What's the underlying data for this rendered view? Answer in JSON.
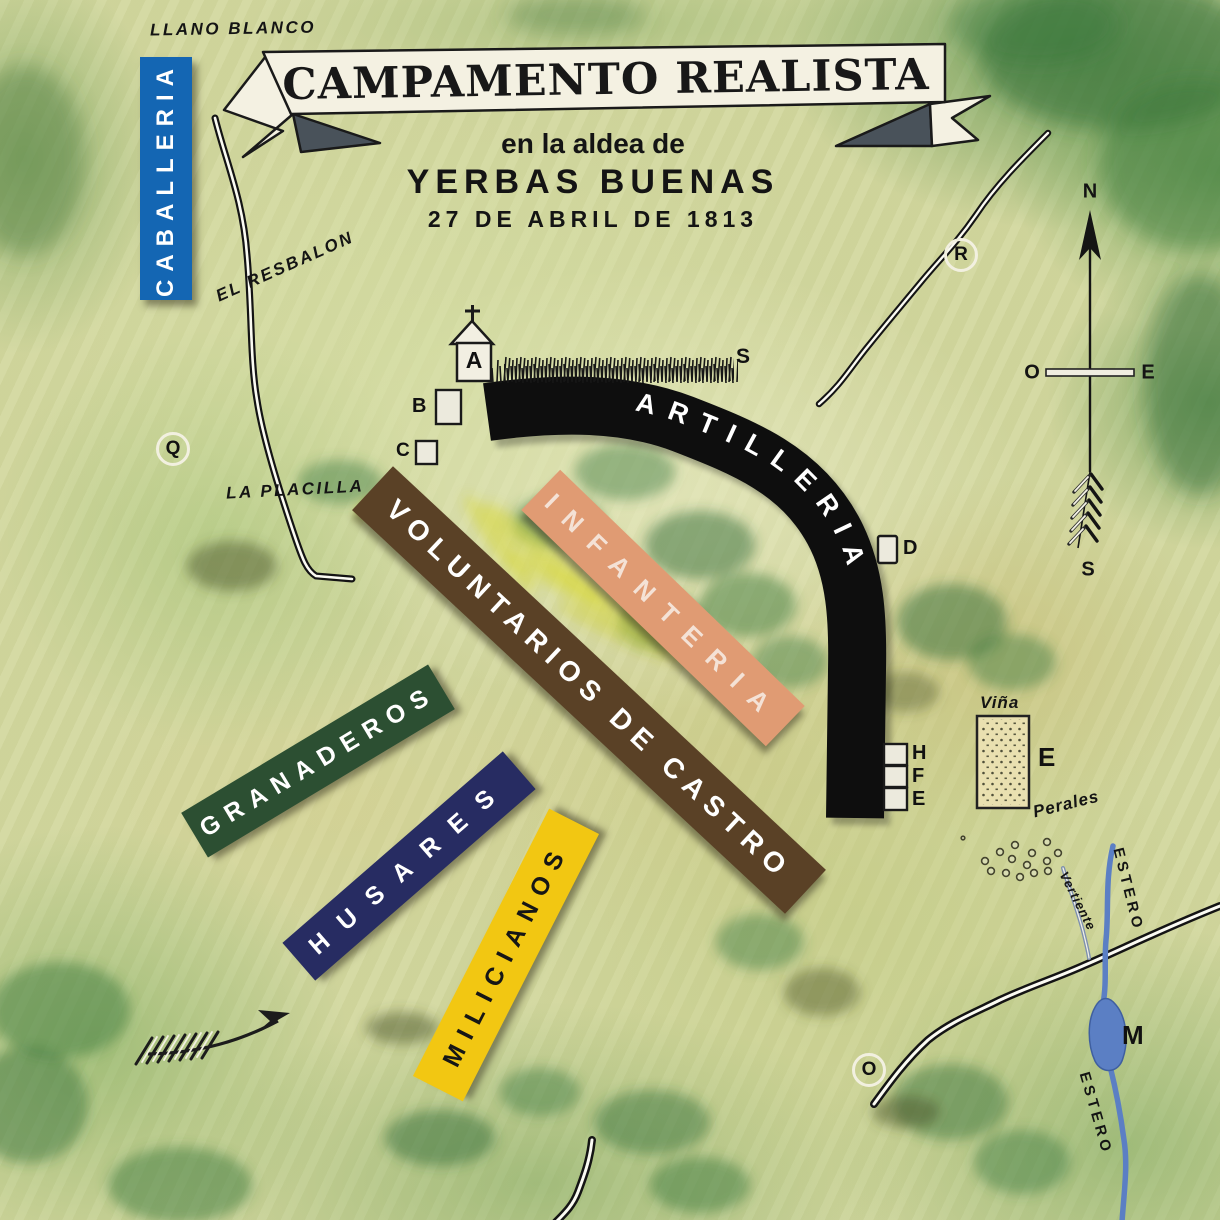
{
  "title": {
    "banner": "CAMPAMENTO REALISTA",
    "line1": "en la aldea de",
    "line2": "YERBAS BUENAS",
    "line3": "27 DE ABRIL DE 1813"
  },
  "units": {
    "caballeria": {
      "label": "CABALLERIA",
      "color": "#1466b3",
      "text_color": "#ffffff"
    },
    "artilleria": {
      "label": "ARTILLERIA",
      "color": "#0e0e0e",
      "text_color": "#ffffff"
    },
    "infanteria": {
      "label": "INFANTERIA",
      "color": "#e09b73",
      "text_color": "#f4e2d6"
    },
    "voluntarios": {
      "label": "VOLUNTARIOS DE CASTRO",
      "color": "#5a4126",
      "text_color": "#ffffff"
    },
    "granaderos": {
      "label": "GRANADEROS",
      "color": "#2c4f32",
      "text_color": "#ffffff"
    },
    "husares": {
      "label": "HUSARES",
      "color": "#272c62",
      "text_color": "#ffffff"
    },
    "milicianos": {
      "label": "MILICIANOS",
      "color": "#f2c712",
      "text_color": "#161616"
    }
  },
  "places": {
    "llano_blanco": "LLANO BLANCO",
    "el_resbalon": "EL RESBALON",
    "la_placilla": "LA PLACILLA",
    "vina": "Viña",
    "perales": "Perales",
    "vertiente": "Vertiente",
    "estero_ne": "ESTERO",
    "estero_se": "ESTERO"
  },
  "markers": {
    "church": "A",
    "building_b": "B",
    "building_c": "C",
    "building_d": "D",
    "building_h": "H",
    "building_f": "F",
    "building_e": "E",
    "vina_e": "E",
    "lake_m": "M",
    "hedge_s": "S",
    "circle_q": "Q",
    "circle_r": "R",
    "circle_o": "O"
  },
  "compass": {
    "north": "N",
    "west": "O",
    "east": "E",
    "south": "S"
  },
  "colors": {
    "water": "#5b7fc4",
    "banner_fill": "#f4f1e2",
    "banner_fold": "#49525a",
    "map_base": "#d3d8a0"
  }
}
